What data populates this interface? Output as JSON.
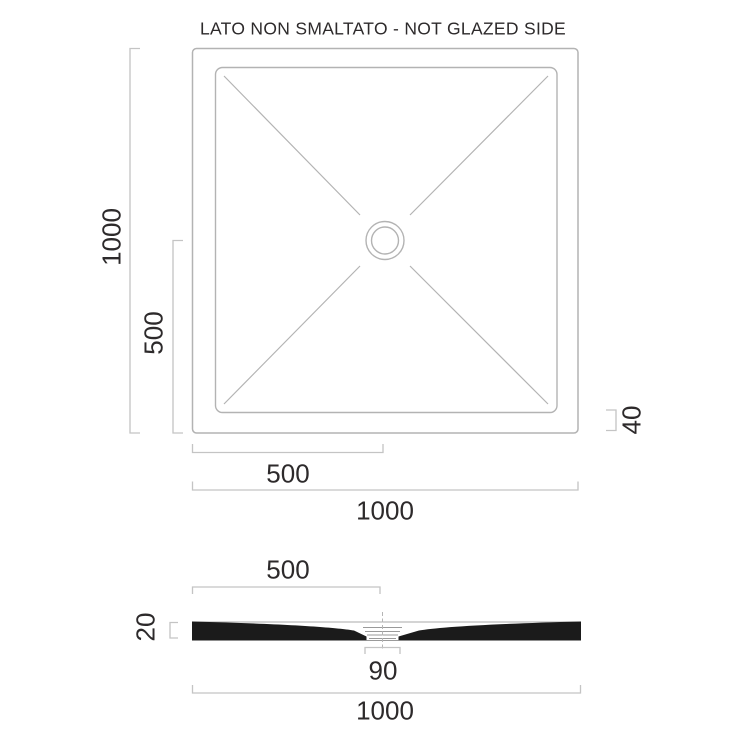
{
  "title": "LATO NON SMALTATO - NOT GLAZED SIDE",
  "plan_view": {
    "name": "shower-tray-plan-view",
    "label_total_height": "1000",
    "label_half_height": "500",
    "label_half_width": "500",
    "label_total_width": "1000",
    "label_edge_height": "40"
  },
  "section_view": {
    "name": "shower-tray-section-view",
    "label_half_width": "500",
    "label_thickness": "20",
    "label_drain_width": "90",
    "label_total_width": "1000"
  },
  "dimensions_mm": {
    "plan_total_width": 1000,
    "plan_total_height": 1000,
    "drain_center_from_left": 500,
    "drain_center_from_bottom": 500,
    "edge_height": 40,
    "section_total_width": 1000,
    "section_half_width_to_drain": 500,
    "rim_thickness": 20,
    "drain_opening_width": 90
  },
  "colors": {
    "background": "#ffffff",
    "drawing_line": "#b3b3b3",
    "dimension_line": "#c4c4c4",
    "text": "#2d2a2b",
    "section_fill": "#1b1b1b"
  }
}
